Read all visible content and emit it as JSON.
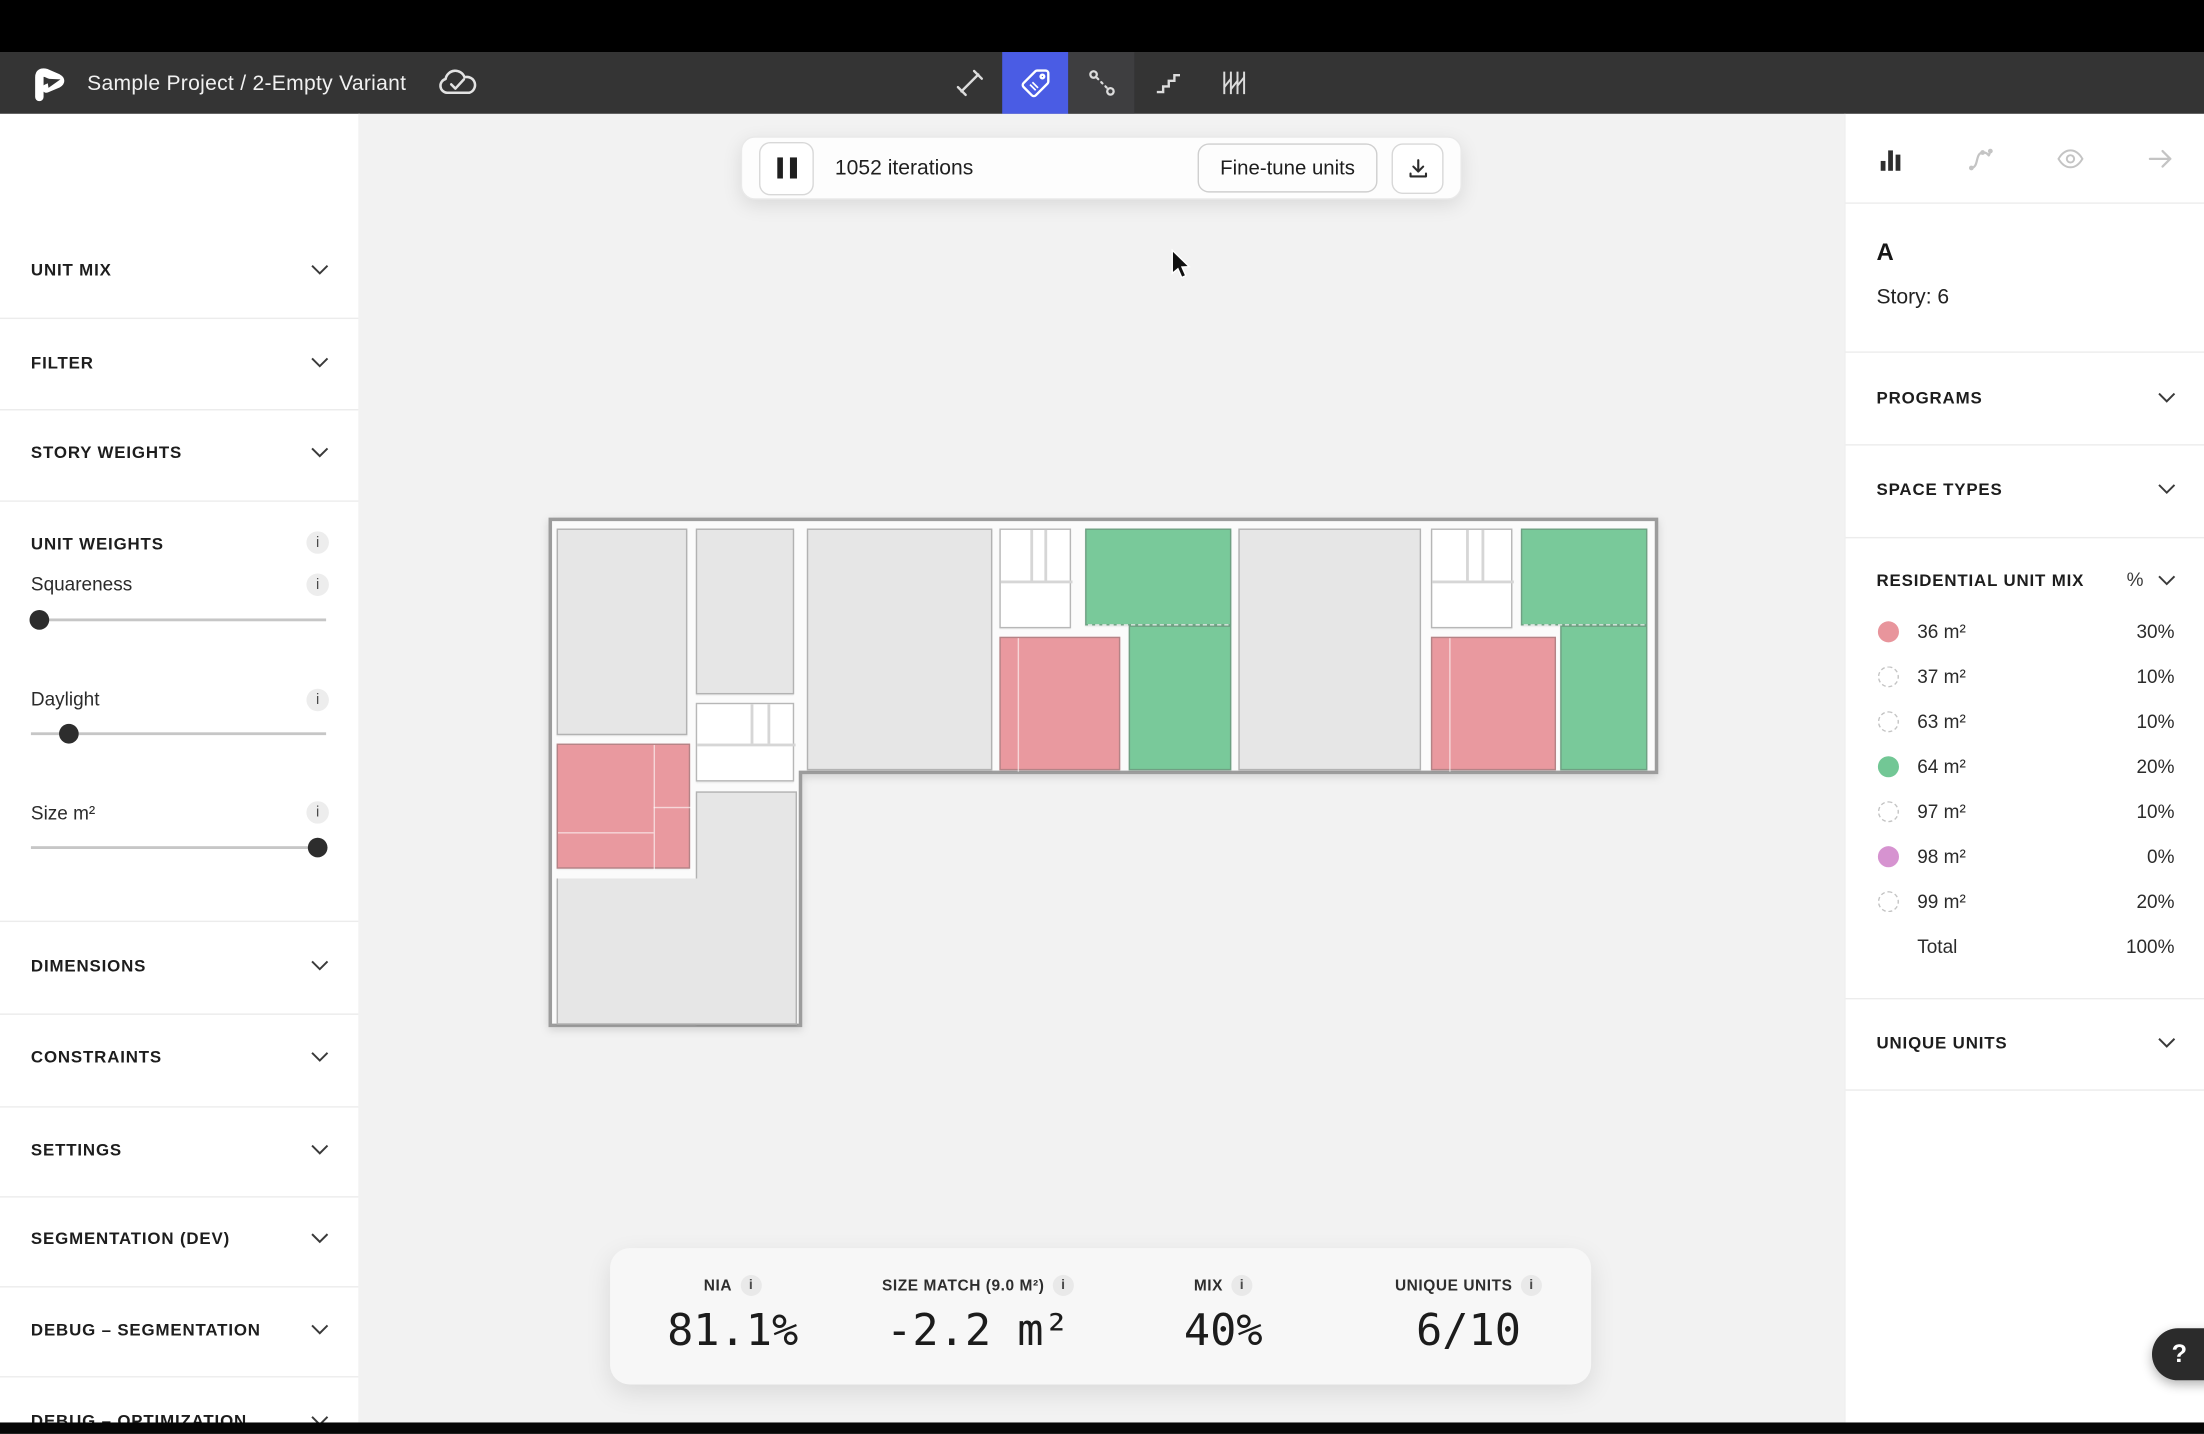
{
  "top_bar": {
    "title": "Sample Project / 2-Empty Variant",
    "sync_icon": "cloud-check-icon",
    "tools": [
      "measure-tool",
      "tag-tool",
      "distance-tool",
      "stairs-tool",
      "hatch-tool"
    ],
    "active_tool": "tag-tool",
    "active_tool_color": "#4a5ce4"
  },
  "run_bar": {
    "iterations": "1052 iterations",
    "fine_tune_label": "Fine-tune units",
    "pause_icon": "pause-icon",
    "download_icon": "download-icon"
  },
  "info_badge": "i",
  "left_sidebar": {
    "unit_mix_label": "UNIT MIX",
    "filter_label": "FILTER",
    "story_weights_label": "STORY WEIGHTS",
    "unit_weights_label": "UNIT WEIGHTS",
    "squareness_label": "Squareness",
    "daylight_label": "Daylight",
    "size_label": "Size m²",
    "dimensions_label": "DIMENSIONS",
    "constraints_label": "CONSTRAINTS",
    "settings_label": "SETTINGS",
    "segmentation_label": "SEGMENTATION (DEV)",
    "debug_segmentation_label": "DEBUG – SEGMENTATION",
    "debug_optimization_label": "DEBUG – OPTIMIZATION",
    "sliders": {
      "squareness_pos": "--p: 3%",
      "daylight_pos": "--p: 13%",
      "size_pos": "--p: 97%"
    }
  },
  "stats": {
    "items": [
      {
        "label": "NIA",
        "value": "81.1%"
      },
      {
        "label": "SIZE MATCH (9.0 M²)",
        "value": "-2.2 m²"
      },
      {
        "label": "MIX",
        "value": "40%"
      },
      {
        "label": "UNIQUE UNITS",
        "value": "6/10"
      }
    ]
  },
  "right_panel": {
    "icons": [
      "bar-chart-icon",
      "spline-icon",
      "eye-icon",
      "arrow-right-icon"
    ],
    "building": "A",
    "story": "Story: 6",
    "programs_label": "PROGRAMS",
    "space_types_label": "SPACE TYPES",
    "unit_mix": {
      "title": "RESIDENTIAL UNIT MIX",
      "unit_toggle": "%",
      "rows": [
        {
          "label": "36 m²",
          "pct": "30%",
          "swatch": "pink"
        },
        {
          "label": "37 m²",
          "pct": "10%",
          "swatch": "dashed"
        },
        {
          "label": "63 m²",
          "pct": "10%",
          "swatch": "dashed"
        },
        {
          "label": "64 m²",
          "pct": "20%",
          "swatch": "green"
        },
        {
          "label": "97 m²",
          "pct": "10%",
          "swatch": "dashed"
        },
        {
          "label": "98 m²",
          "pct": "0%",
          "swatch": "orchid"
        },
        {
          "label": "99 m²",
          "pct": "20%",
          "swatch": "dashed"
        }
      ],
      "total_label": "Total",
      "total_value": "100%"
    },
    "unique_units_label": "UNIQUE UNITS"
  },
  "floor_plan": {
    "canvas_bg": "#f2f2f2",
    "unit_colors": {
      "standard": "#e6e6e6",
      "type_36m2": "#e9999f",
      "type_64m2": "#79c99a",
      "core": "#ffffff"
    }
  },
  "help": {
    "label": "?"
  }
}
